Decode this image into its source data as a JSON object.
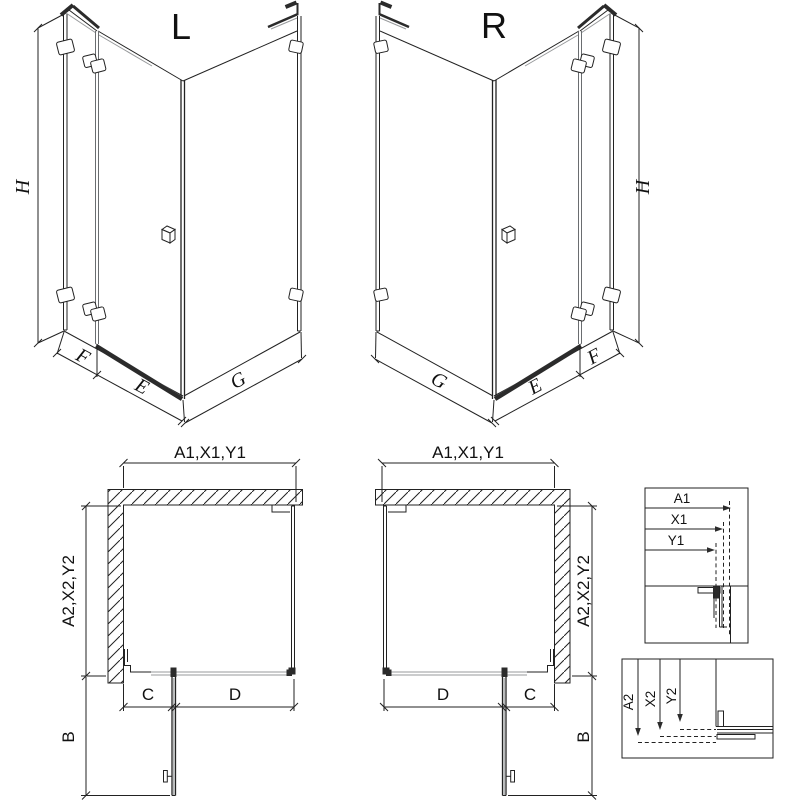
{
  "colors": {
    "background": "#ffffff",
    "line": "#222222",
    "glass": "#97999b",
    "hatch": "#3c3c3c",
    "fill_dark": "#2b2b2b"
  },
  "iso_left": {
    "title": "L",
    "dim_height": "H",
    "dim_f": "F",
    "dim_e": "E",
    "dim_g": "G"
  },
  "iso_right": {
    "title": "R",
    "dim_height": "H",
    "dim_f": "F",
    "dim_e": "E",
    "dim_g": "G"
  },
  "plan_left": {
    "dim_width": "A1,X1,Y1",
    "dim_depth": "A2,X2,Y2",
    "dim_c": "C",
    "dim_d": "D",
    "dim_b": "B"
  },
  "plan_right": {
    "dim_width": "A1,X1,Y1",
    "dim_depth": "A2,X2,Y2",
    "dim_c": "C",
    "dim_d": "D",
    "dim_b": "B"
  },
  "detail_width": {
    "labels": [
      "A1",
      "X1",
      "Y1"
    ]
  },
  "detail_depth": {
    "labels": [
      "A2",
      "X2",
      "Y2"
    ]
  }
}
